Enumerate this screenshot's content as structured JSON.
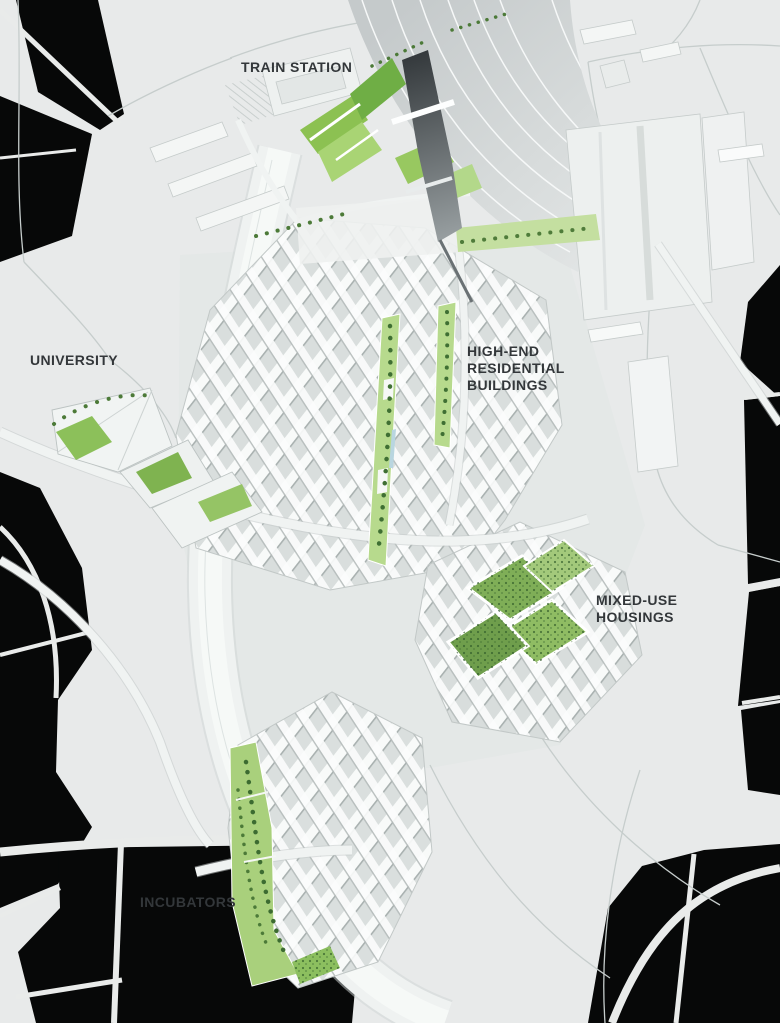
{
  "page": {
    "width_px": 780,
    "height_px": 1023,
    "background": "#e8eaea"
  },
  "map": {
    "kind": "architectural-masterplan-rendering",
    "labels": [
      {
        "id": "train-station",
        "text": "TRAIN STATION"
      },
      {
        "id": "university",
        "text": "UNIVERSITY"
      },
      {
        "id": "high-end-residential",
        "text": "HIGH-END\nRESIDENTIAL\nBUILDINGS"
      },
      {
        "id": "mixed-use-housings",
        "text": "MIXED-USE\nHOUSINGS"
      },
      {
        "id": "incubators",
        "text": "INCUBATORS"
      }
    ],
    "palette": {
      "ground": "#e8eaea",
      "context_black": "#070808",
      "building_white": "#f4f6f5",
      "road_light": "#f0f3f2",
      "road_edge": "#c6cdcc",
      "rail_gray": "#c9cecf",
      "bridge_dark": "#33383b",
      "green_light": "#b7da8d",
      "green_mid": "#8cc152",
      "green_dark": "#3f6f33",
      "water_blue": "#b9d6e0",
      "label_text": "#33373a"
    }
  }
}
